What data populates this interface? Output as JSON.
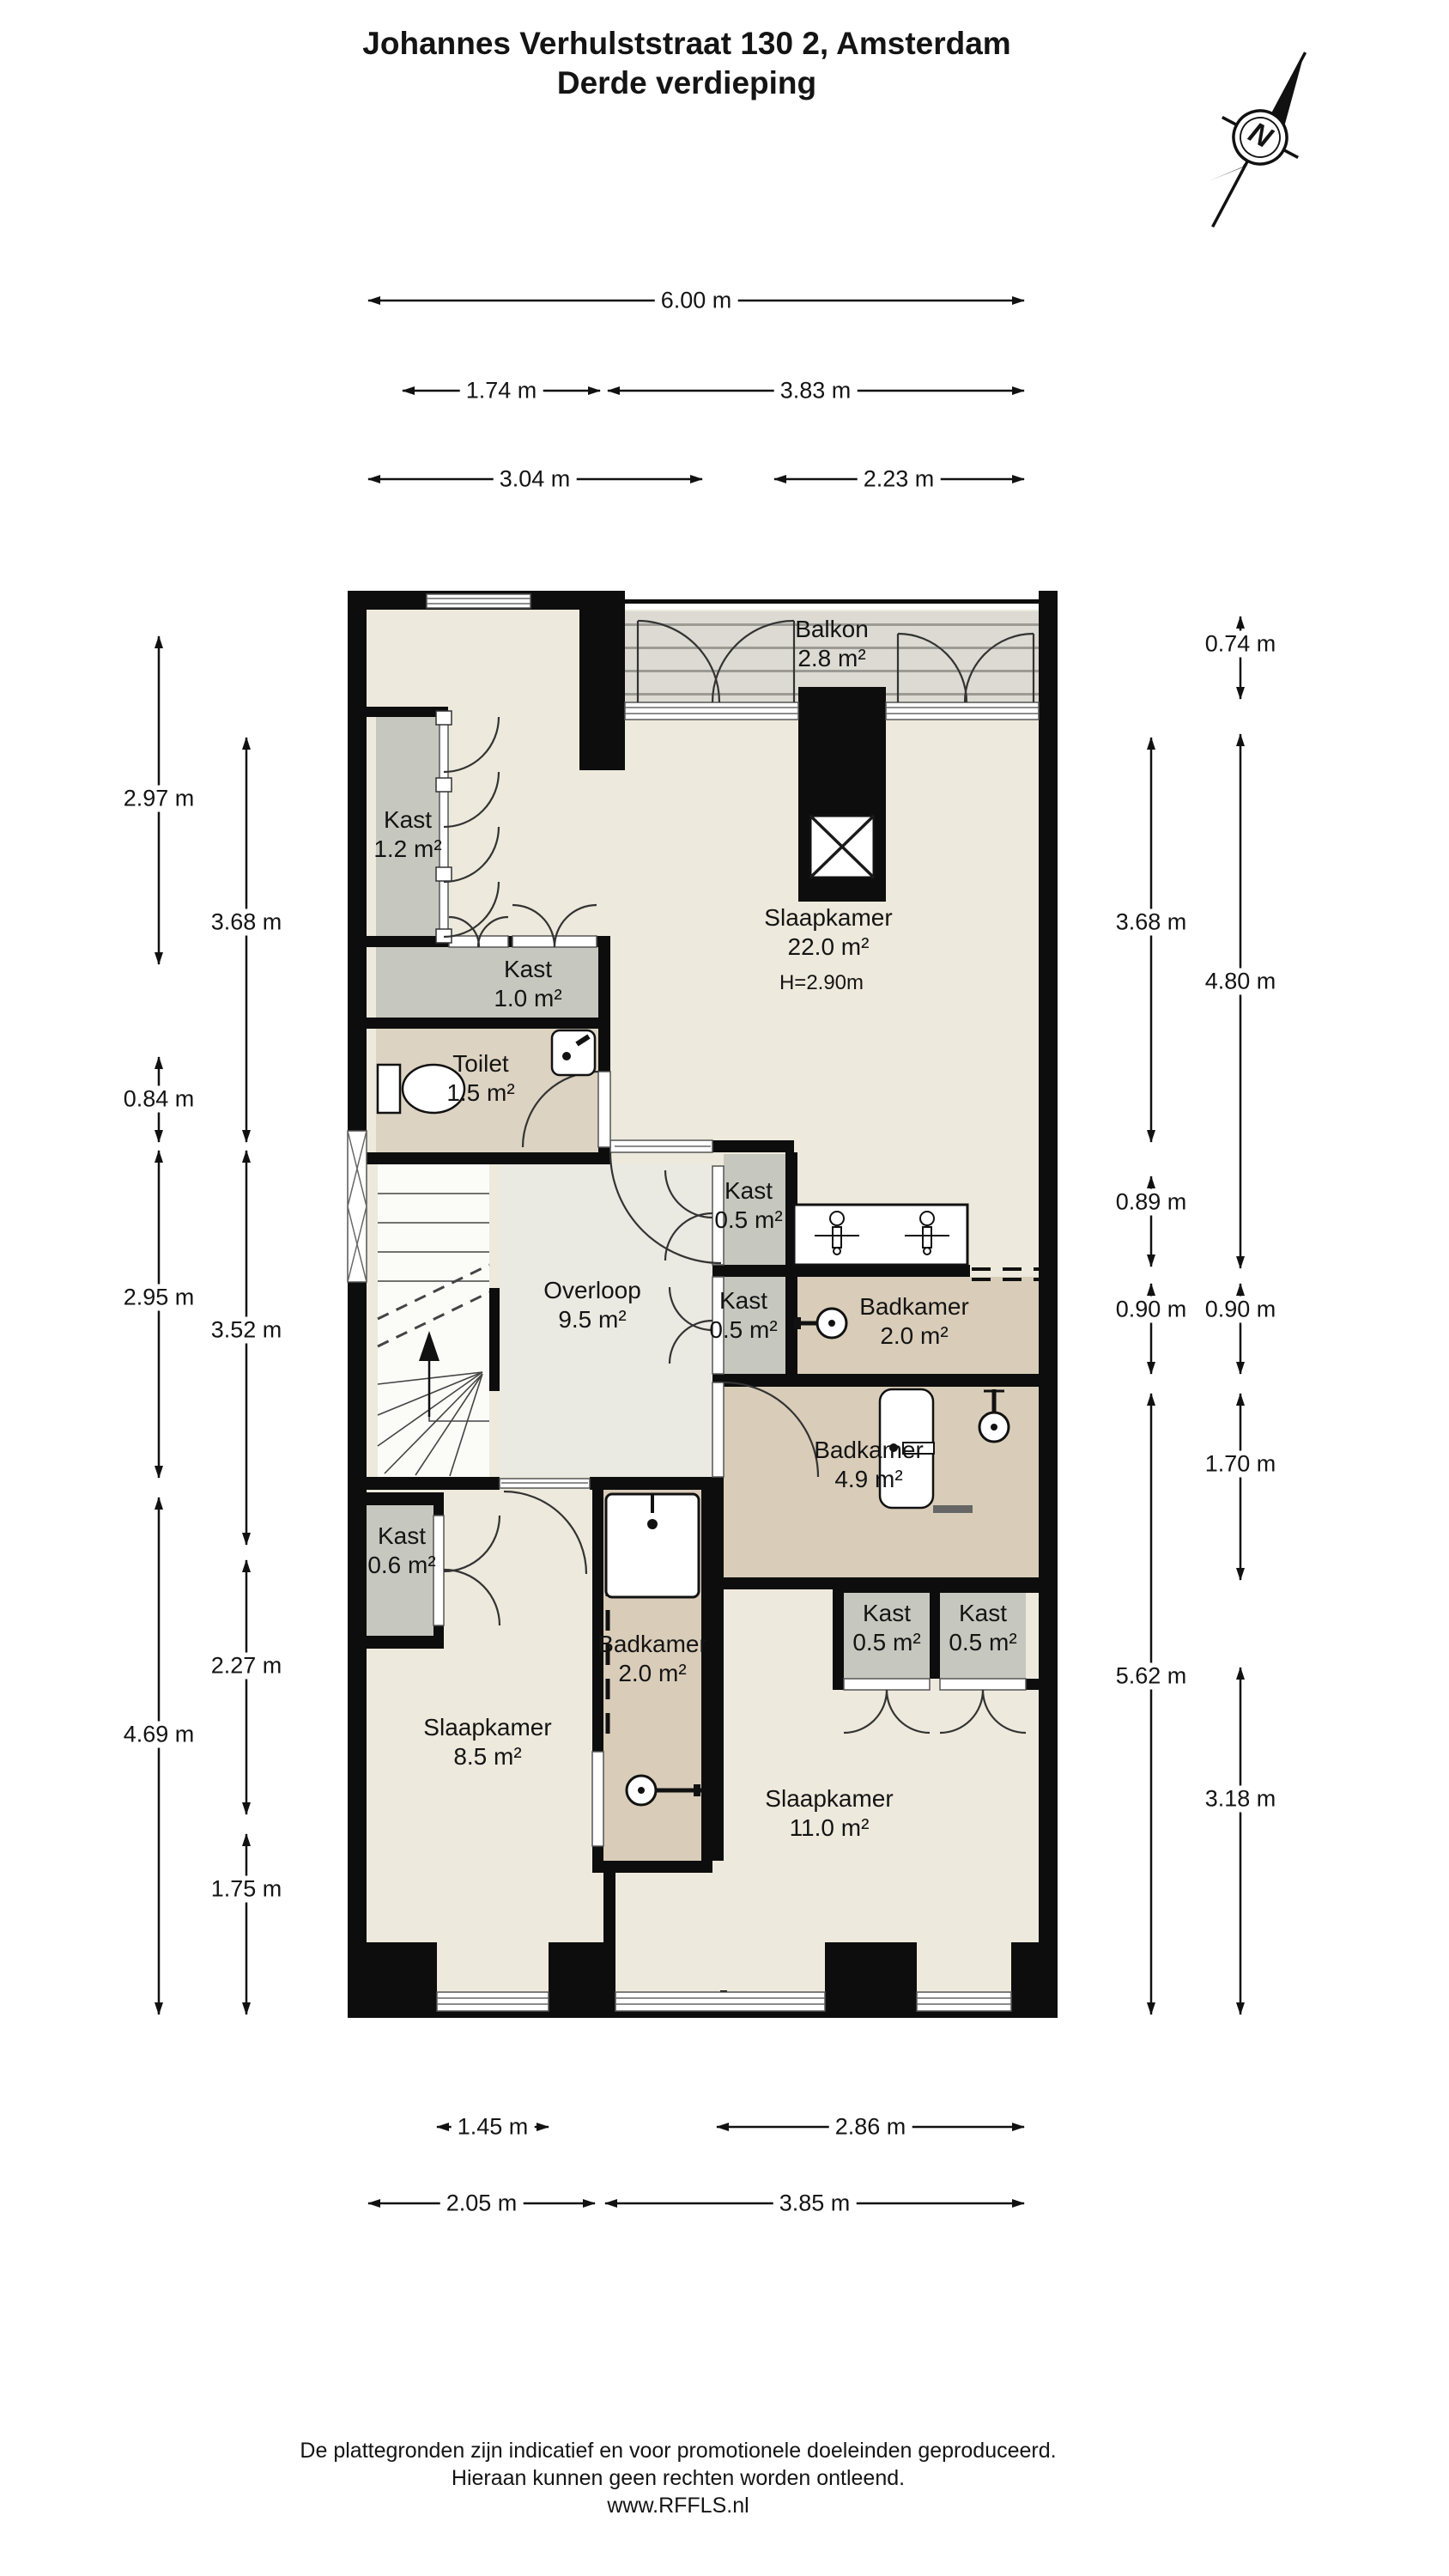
{
  "title": {
    "line1": "Johannes Verhulststraat 130 2, Amsterdam",
    "line2": "Derde verdieping"
  },
  "compass": {
    "label": "N"
  },
  "rooms": [
    {
      "id": "balkon",
      "label": "Balkon",
      "area": "2.8 m²"
    },
    {
      "id": "kast-1-2",
      "label": "Kast",
      "area": "1.2 m²"
    },
    {
      "id": "slaapkamer-22",
      "label": "Slaapkamer",
      "area": "22.0 m²",
      "height": "H=2.90m"
    },
    {
      "id": "kast-1-0",
      "label": "Kast",
      "area": "1.0 m²"
    },
    {
      "id": "toilet",
      "label": "Toilet",
      "area": "1.5 m²"
    },
    {
      "id": "kast-0-5-a",
      "label": "Kast",
      "area": "0.5 m²"
    },
    {
      "id": "overloop",
      "label": "Overloop",
      "area": "9.5 m²"
    },
    {
      "id": "kast-0-5-b",
      "label": "Kast",
      "area": "0.5 m²"
    },
    {
      "id": "badkamer-2-0-r",
      "label": "Badkamer",
      "area": "2.0 m²"
    },
    {
      "id": "badkamer-4-9",
      "label": "Badkamer",
      "area": "4.9 m²"
    },
    {
      "id": "kast-0-6",
      "label": "Kast",
      "area": "0.6 m²"
    },
    {
      "id": "kast-0-5-c",
      "label": "Kast",
      "area": "0.5 m²"
    },
    {
      "id": "kast-0-5-d",
      "label": "Kast",
      "area": "0.5 m²"
    },
    {
      "id": "badkamer-2-0-b",
      "label": "Badkamer",
      "area": "2.0 m²"
    },
    {
      "id": "slaapkamer-8-5",
      "label": "Slaapkamer",
      "area": "8.5 m²"
    },
    {
      "id": "slaapkamer-11",
      "label": "Slaapkamer",
      "area": "11.0 m²"
    }
  ],
  "dims": {
    "top": [
      "6.00 m",
      "1.74 m",
      "3.83 m",
      "3.04 m",
      "2.23 m"
    ],
    "bottom": [
      "1.45 m",
      "2.86 m",
      "2.05 m",
      "3.85 m"
    ],
    "left": [
      "2.97 m",
      "3.68 m",
      "0.84 m",
      "2.95 m",
      "3.52 m",
      "4.69 m",
      "2.27 m",
      "1.75 m"
    ],
    "right": [
      "0.74 m",
      "3.68 m",
      "4.80 m",
      "0.89 m",
      "0.90 m",
      "0.90 m",
      "5.62 m",
      "1.70 m",
      "3.18 m"
    ]
  },
  "footer": {
    "line1": "De plattegronden zijn indicatief en voor promotionele doeleinden geproduceerd.",
    "line2": "Hieraan kunnen geen rechten worden ontleend.",
    "line3": "www.RFFLS.nl"
  },
  "colors": {
    "walls": "#0d0d0d",
    "room_fill": "#EDE9DC",
    "closet_fill": "#C6C7BE",
    "bathroom_fill": "#D9CDB9",
    "toilet_fill": "#DDD3C2",
    "balcony_fill": "#DCDAD2",
    "landing_fill": "#EAE9E2",
    "stairs_fill": "#FBFBF8"
  }
}
